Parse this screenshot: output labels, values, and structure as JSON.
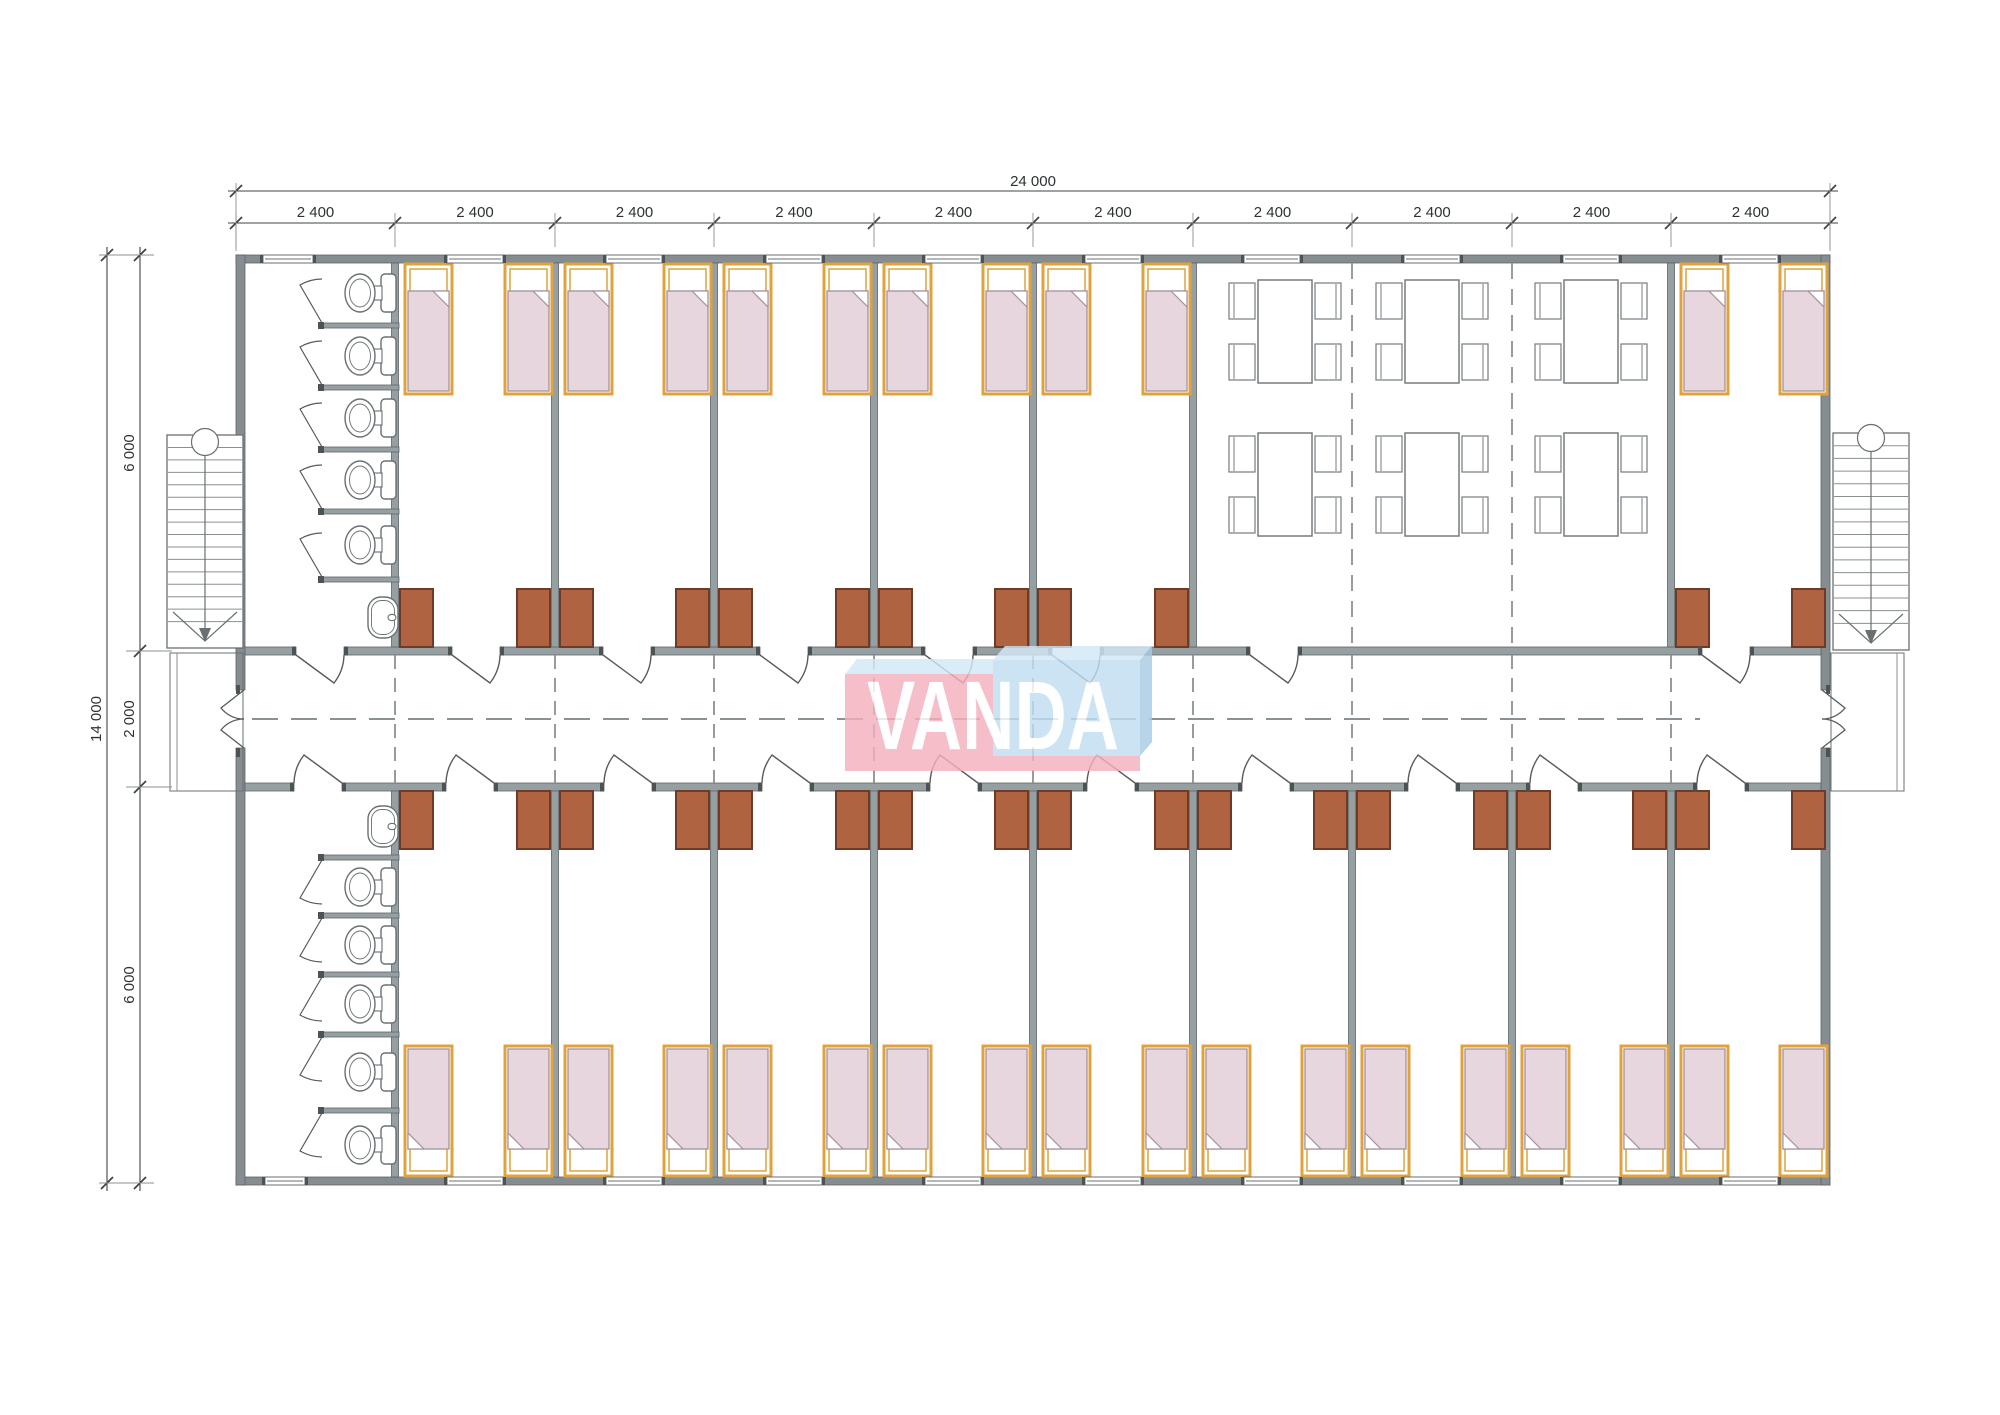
{
  "meta": {
    "drawing_type": "architectural-floor-plan",
    "building": "modular dormitory with central corridor"
  },
  "logo": {
    "text": "VANDA",
    "pink": "#f4b0bd",
    "blue": "#c0ddf1",
    "top_face": "#d3e9f7",
    "side_face": "#a9cbe3",
    "text_color": "#ffffff",
    "opacity": 0.82
  },
  "dimensions": {
    "total_width_label": "24 000",
    "module_width_label": "2 400",
    "module_count": 10,
    "total_height_label": "14 000",
    "upper_rooms_depth_label": "6 000",
    "corridor_width_label": "2 000",
    "lower_rooms_depth_label": "6 000"
  },
  "colors": {
    "wall": "#868d90",
    "interior_wall": "#96a0a3",
    "wall_edge": "#5d6466",
    "jamb": "#4d5355",
    "window_frame": "#6b7275",
    "wardrobe": "#b06340",
    "wardrobe_edge": "#6e3b26",
    "bed_frame": "#dfa23c",
    "blanket": "#e7d6dd",
    "blanket_line": "#a3929c",
    "fixture": "#6a7072",
    "furniture": "#767c7e",
    "door": "#565c5e",
    "dash": "#8a9194",
    "dim": "#3f4446",
    "dim_text": "#2e3234",
    "ext": "#8a9092",
    "stair": "#6a7072",
    "tread": "#8a9092"
  },
  "plan": {
    "module_boundaries": [
      236,
      395,
      555,
      714,
      874,
      1033,
      1193,
      1352,
      1512,
      1671,
      1830
    ],
    "exterior": {
      "top_y": 255,
      "bottom_y": 1177,
      "left_x": 236,
      "right_x": 1821,
      "side_thickness": 9,
      "band_thickness": 8
    },
    "corridor": {
      "top_wall_y": 647,
      "bottom_wall_y": 783,
      "wall_thickness": 8,
      "centerline_y": 719,
      "center_dash_x": [
        252,
        1700
      ]
    },
    "entrance_opening_y": [
      690,
      748
    ],
    "partitions_top": [
      395,
      555,
      714,
      874,
      1033,
      1193,
      1671
    ],
    "partitions_bottom": [
      395,
      555,
      714,
      874,
      1033,
      1193,
      1352,
      1512,
      1671
    ],
    "doors_top_x": [
      296,
      452,
      603,
      760,
      925,
      1052,
      1250,
      1702
    ],
    "doors_bottom_x": [
      294,
      446,
      604,
      762,
      930,
      1087,
      1242,
      1408,
      1530,
      1697
    ],
    "door_width": 48,
    "windows_top": [
      [
        288,
        50
      ],
      [
        475,
        56
      ],
      [
        634,
        56
      ],
      [
        794,
        56
      ],
      [
        953,
        56
      ],
      [
        1113,
        56
      ],
      [
        1272,
        56
      ],
      [
        1432,
        56
      ],
      [
        1591,
        56
      ],
      [
        1750,
        56
      ]
    ],
    "windows_bottom": [
      [
        285,
        40
      ],
      [
        475,
        56
      ],
      [
        634,
        56
      ],
      [
        794,
        56
      ],
      [
        953,
        56
      ],
      [
        1113,
        56
      ],
      [
        1272,
        56
      ],
      [
        1432,
        56
      ],
      [
        1591,
        56
      ],
      [
        1750,
        56
      ]
    ],
    "bedroom_modules_top": [
      2,
      3,
      4,
      5,
      6,
      10
    ],
    "bedroom_modules_bottom": [
      2,
      3,
      4,
      5,
      6,
      7,
      8,
      9,
      10
    ],
    "beds": {
      "width": 47,
      "height": 130,
      "top_y": 264,
      "bottom_y": 1046
    },
    "wardrobes": {
      "width": 33,
      "height": 58,
      "top_y": 589,
      "bottom_y": 791
    },
    "stall_x": [
      322,
      399
    ],
    "bath_top": {
      "divider_ys": [
        323,
        385,
        447,
        509,
        577
      ],
      "toilet_cys": [
        293,
        356,
        418,
        480,
        545
      ],
      "sink_y": 597
    },
    "bath_bottom": {
      "divider_ys": [
        855,
        913,
        972,
        1032,
        1108
      ],
      "toilet_cys": [
        887,
        945,
        1004,
        1072,
        1145
      ],
      "sink_y": 806
    },
    "dining": {
      "table_cxs": [
        1285,
        1432,
        1591
      ],
      "row_ys": [
        280,
        433
      ],
      "table_w": 54,
      "table_h": 103,
      "chair_w": 26,
      "chair_h": 36,
      "divider_dash_x": [
        1352,
        1512
      ]
    },
    "stairs": {
      "left": {
        "x": 167,
        "y": 435,
        "w": 76,
        "h": 213,
        "circle": [
          205,
          442
        ]
      },
      "right": {
        "x": 1833,
        "y": 433,
        "w": 76,
        "h": 217,
        "circle": [
          1871,
          438
        ]
      },
      "tread_count": 15
    },
    "porches": {
      "left": [
        170,
        653,
        73,
        138
      ],
      "right": [
        1831,
        653,
        73,
        138
      ]
    }
  }
}
